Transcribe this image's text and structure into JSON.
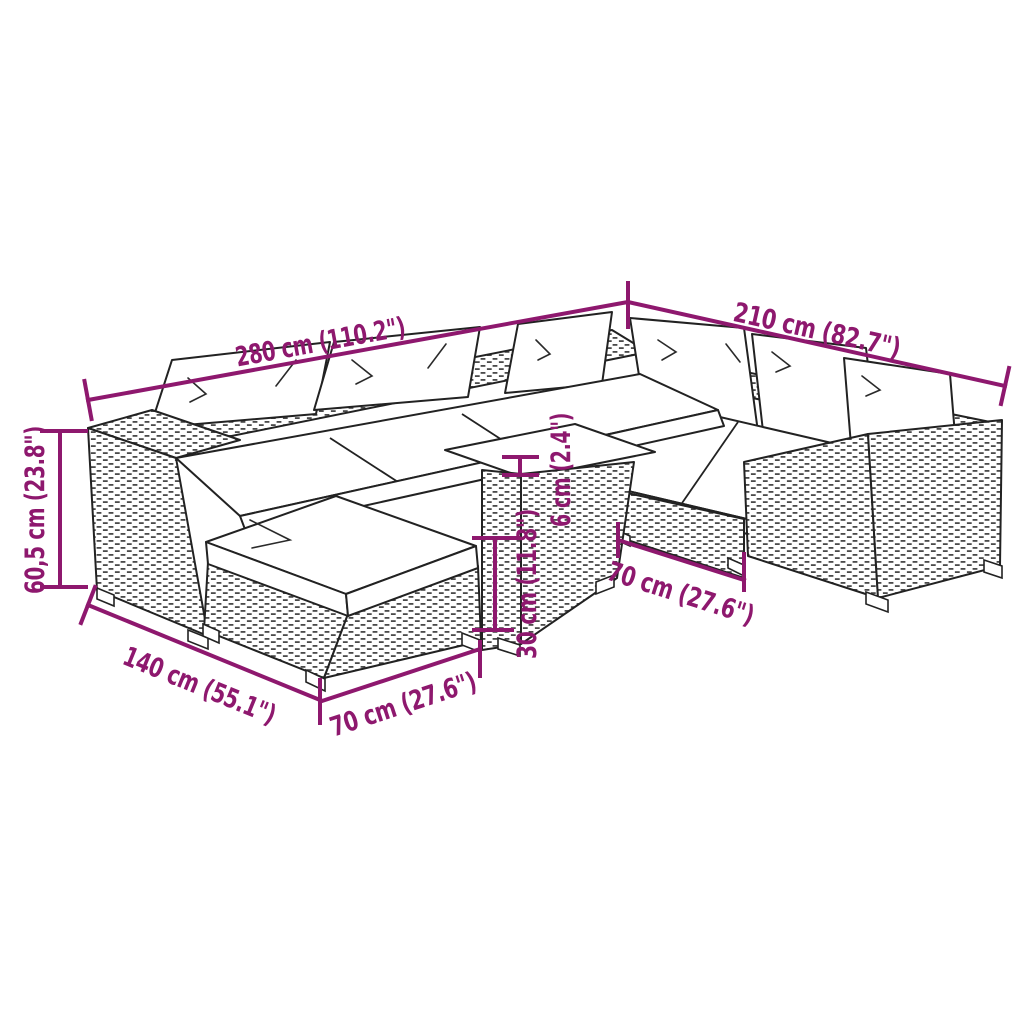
{
  "subject": "rattan-garden-lounge-set-dimension-diagram",
  "canvas": {
    "background": "#ffffff",
    "width": 1024,
    "height": 1024
  },
  "colors": {
    "annotation": "#8E186E",
    "line_art": "#222222",
    "cushion_fill": "#ffffff"
  },
  "illustration": {
    "parts": [
      "left-arm-module",
      "back-cushions",
      "seat-cushions",
      "corner-module",
      "right-arm-module",
      "footstool-with-cushion",
      "coffee-table"
    ]
  },
  "dims": {
    "total_width": {
      "label": "280 cm (110.2\")"
    },
    "right_depth": {
      "label": "210 cm (82.7\")"
    },
    "back_height": {
      "label": "60,5 cm (23.8\")"
    },
    "left_depth": {
      "label": "140 cm (55.1\")"
    },
    "ottoman_front_width": {
      "label": "70 cm (27.6\")"
    },
    "seat_height": {
      "label": "30 cm (11.8\")"
    },
    "cushion_thickness": {
      "label": "6 cm (2.4\")"
    },
    "module_front_width": {
      "label": "70 cm (27.6\")"
    }
  }
}
